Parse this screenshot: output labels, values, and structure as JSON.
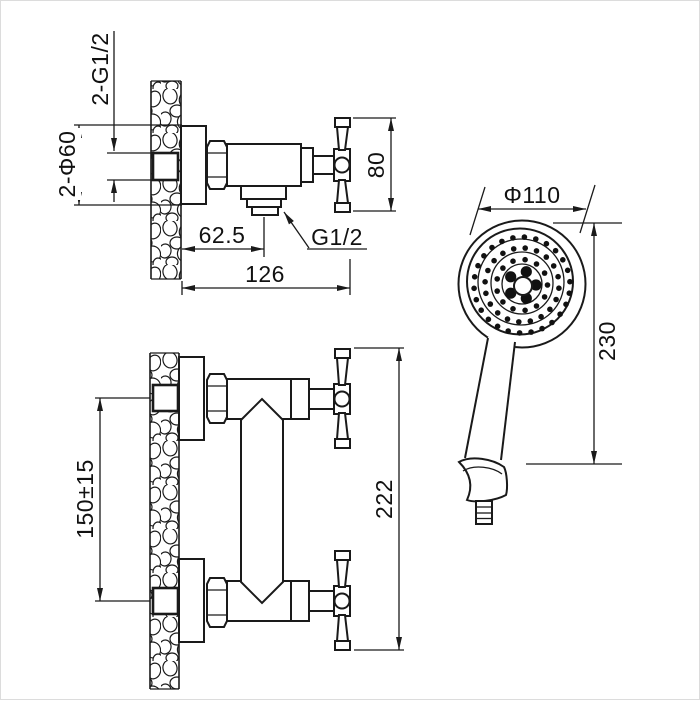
{
  "meta": {
    "drawing_type": "shower mixer installation drawing",
    "background": "#ffffff",
    "line_color": "#1a1a1a"
  },
  "dims": {
    "inlet_threads": "2-G1/2",
    "escutcheon_diameter": "2-Φ60",
    "outlet_offset": "62.5",
    "outlet_thread": "G1/2",
    "total_projection": "126",
    "handle_span": "80",
    "inlet_spacing": "150±15",
    "overall_height": "222",
    "head_diameter": "Φ110",
    "shower_length": "230"
  },
  "shower_head": {
    "center": {
      "x": 521,
      "y": 284
    },
    "dot_radius": 2.8,
    "dot_rings": [
      {
        "radius": 48,
        "count": 26,
        "offset_deg": -4
      },
      {
        "radius": 37,
        "count": 20,
        "offset_deg": 5
      },
      {
        "radius": 25.5,
        "count": 13,
        "offset_deg": 0
      }
    ],
    "big_dots": {
      "ring_radius": 14,
      "count": 5,
      "dot_radius": 5.6,
      "offset_deg": -72
    }
  }
}
